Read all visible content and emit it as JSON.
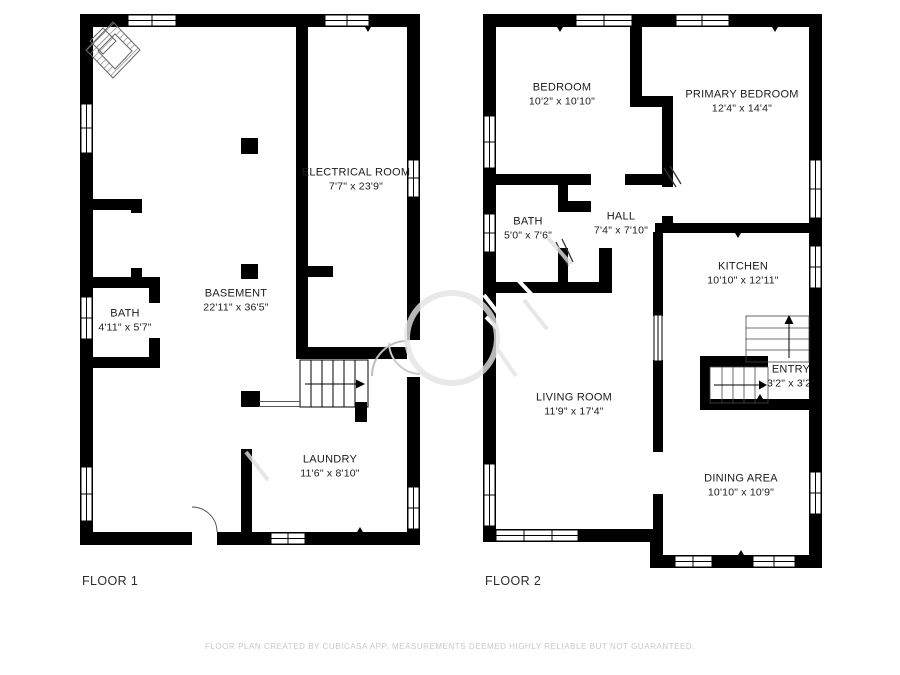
{
  "floor1": {
    "label": "FLOOR 1",
    "rooms": {
      "electrical": {
        "name": "ELECTRICAL ROOM",
        "dims": "7'7\" x 23'9\""
      },
      "basement": {
        "name": "BASEMENT",
        "dims": "22'11\" x 36'5\""
      },
      "bath": {
        "name": "BATH",
        "dims": "4'11\" x 5'7\""
      },
      "laundry": {
        "name": "LAUNDRY",
        "dims": "11'6\" x 8'10\""
      }
    }
  },
  "floor2": {
    "label": "FLOOR 2",
    "rooms": {
      "bedroom": {
        "name": "BEDROOM",
        "dims": "10'2\" x 10'10\""
      },
      "primary": {
        "name": "PRIMARY BEDROOM",
        "dims": "12'4\" x 14'4\""
      },
      "bath": {
        "name": "BATH",
        "dims": "5'0\" x 7'6\""
      },
      "hall": {
        "name": "HALL",
        "dims": "7'4\" x 7'10\""
      },
      "kitchen": {
        "name": "KITCHEN",
        "dims": "10'10\" x 12'11\""
      },
      "entry": {
        "name": "ENTRY",
        "dims": "3'2\" x 3'2\""
      },
      "living": {
        "name": "LIVING ROOM",
        "dims": "11'9\" x 17'4\""
      },
      "dining": {
        "name": "DINING AREA",
        "dims": "10'10\" x 10'9\""
      }
    }
  },
  "footer": {
    "disclaimer": "FLOOR PLAN CREATED BY CUBICASA APP. MEASUREMENTS DEEMED HIGHLY RELIABLE BUT NOT GUARANTEED."
  },
  "icons": {
    "compass": "compass-rose-icon",
    "stair_arrow": "direction-arrow-icon"
  },
  "colors": {
    "wall": "#000000",
    "label_text": "#1b1b1b",
    "floor_label_text": "#2d2d2d",
    "disclaimer_text": "#c8c8c8",
    "watermark": "#e3e3e3"
  }
}
